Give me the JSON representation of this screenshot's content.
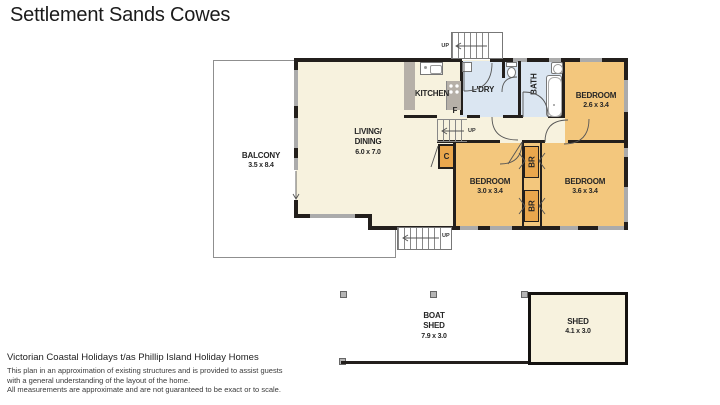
{
  "title": "Settlement Sands Cowes",
  "colors": {
    "wall": "#231f1c",
    "window": "#ababab",
    "cream": "#f7f2de",
    "orange": "#f3c77d",
    "robe": "#eaa74d",
    "blue": "#dbe6f2",
    "counter": "#b6b0a8",
    "text": "#262626",
    "balcony_border": "#8f8f8f"
  },
  "rooms": {
    "balcony": {
      "name": "BALCONY",
      "dims": "3.5 x 8.4"
    },
    "living": {
      "name_line1": "LIVING/",
      "name_line2": "DINING",
      "dims": "6.0 x 7.0"
    },
    "kitchen": {
      "name": "KITCHEN"
    },
    "laundry": {
      "name": "L'DRY"
    },
    "bath": {
      "name": "BATH"
    },
    "bedroom1": {
      "name": "BEDROOM",
      "dims": "2.6 x 3.4"
    },
    "bedroom2": {
      "name": "BEDROOM",
      "dims": "3.0 x 3.4"
    },
    "bedroom3": {
      "name": "BEDROOM",
      "dims": "3.6 x 3.4"
    },
    "boatshed": {
      "name_line1": "BOAT",
      "name_line2": "SHED",
      "dims": "7.9 x 3.0"
    },
    "shed": {
      "name": "SHED",
      "dims": "4.1 x 3.0"
    }
  },
  "labels": {
    "up": "UP",
    "fridge": "F",
    "cupboard": "C",
    "robe": "BR"
  },
  "icons": {
    "stove": "cooktop-4-burners",
    "sink": "kitchen-sink",
    "dishwasher": "appliance-box",
    "toilet": "toilet",
    "basin": "hand-basin",
    "bathtub": "bathtub",
    "stairs": "stairs-with-up-arrow",
    "door_swing": "door-swing-arc",
    "post": "support-post"
  },
  "footer": {
    "line1": "Victorian Coastal Holidays t/as Phillip Island Holiday Homes",
    "line2": "This plan in an approximation of existing structures and is provided to assist guests",
    "line3": "with a general understanding of the layout of the home.",
    "line4": "All measurements are approximate and are not guaranteed to be exact or to scale."
  }
}
